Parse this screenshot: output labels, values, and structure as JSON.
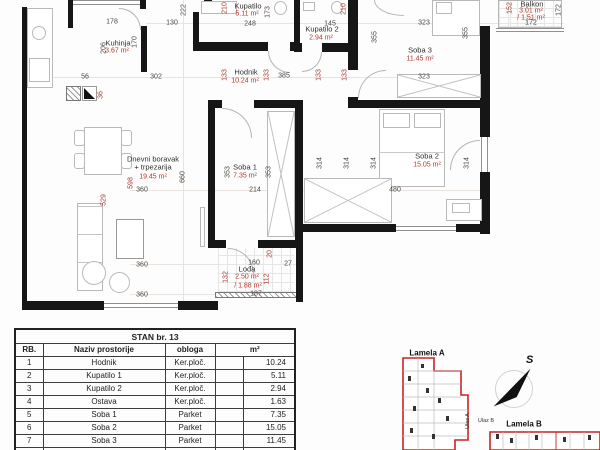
{
  "colors": {
    "wall": "#161616",
    "dimension_red": "#a8382e",
    "area_red": "#b5362b",
    "keyplan_outline_red": "#cc2222"
  },
  "rooms": {
    "kuhinja": {
      "name": "Kuhinja",
      "area": "3.67 m²"
    },
    "kupatilo": {
      "name": "Kupatilo",
      "area": "5.11 m²"
    },
    "kupatilo2": {
      "name": "Kupatilo 2",
      "area": "2.94 m²"
    },
    "hodnik": {
      "name": "Hodnik",
      "area": "10.24 m²"
    },
    "soba3": {
      "name": "Soba 3",
      "area": "11.45 m²"
    },
    "balkon": {
      "name": "Balkon",
      "area": "3.01 m²",
      "area_half": "/ 1.51 m²"
    },
    "soba1": {
      "name": "Soba 1",
      "area": "7.35 m²"
    },
    "soba2": {
      "name": "Soba 2",
      "area": "15.05 m²"
    },
    "dnevni": {
      "name_line1": "Dnevni boravak",
      "name_line2": "+ trpezarija",
      "area": "19.45 m²"
    },
    "lodja": {
      "name": "Lođa",
      "area": "2.50 m²",
      "area_half": "/ 1.88 m²"
    }
  },
  "dims": {
    "d222": "222",
    "d178": "178",
    "d130": "130",
    "d206": "206",
    "d170": "170",
    "d302": "302",
    "d56": "56",
    "d36": "36",
    "d210": "210",
    "d248": "248",
    "d173": "173",
    "d145": "145",
    "d323": "323",
    "d355": "355",
    "d152": "152",
    "d172": "172",
    "d385": "385",
    "d133": "133",
    "d353": "353",
    "d214": "214",
    "d660": "660",
    "d598": "598",
    "d360": "360",
    "d529": "529",
    "d314": "314",
    "d480": "480",
    "d160": "160",
    "d27": "27",
    "d20": "20",
    "d132": "132",
    "d112": "112",
    "d187": "187"
  },
  "table": {
    "title": "STAN br. 13",
    "col_rb": "RB.",
    "col_naziv": "Naziv prostorije",
    "col_obloga": "obloga",
    "col_m2": "m²",
    "rows": [
      {
        "rb": "1",
        "naziv": "Hodnik",
        "obloga": "Ker.ploč.",
        "m2": "10.24"
      },
      {
        "rb": "2",
        "naziv": "Kupatilo 1",
        "obloga": "Ker.ploč.",
        "m2": "5.11"
      },
      {
        "rb": "3",
        "naziv": "Kupatilo 2",
        "obloga": "Ker.ploč.",
        "m2": "2.94"
      },
      {
        "rb": "4",
        "naziv": "Ostava",
        "obloga": "Ker.ploč.",
        "m2": "1.63"
      },
      {
        "rb": "5",
        "naziv": "Soba 1",
        "obloga": "Parket",
        "m2": "7.35"
      },
      {
        "rb": "6",
        "naziv": "Soba 2",
        "obloga": "Parket",
        "m2": "15.05"
      },
      {
        "rb": "7",
        "naziv": "Soba 3",
        "obloga": "Parket",
        "m2": "11.45"
      },
      {
        "rb": "8",
        "naziv": "Dnevni boravak sa trpezarijom",
        "obloga": "Parket.",
        "m2": "19.45"
      }
    ]
  },
  "keyplan": {
    "lamela_a": "Lamela A",
    "lamela_b": "Lamela B",
    "ulaz_a": "Ulaz A",
    "ulaz_b": "Ulaz B",
    "compass": "S"
  }
}
